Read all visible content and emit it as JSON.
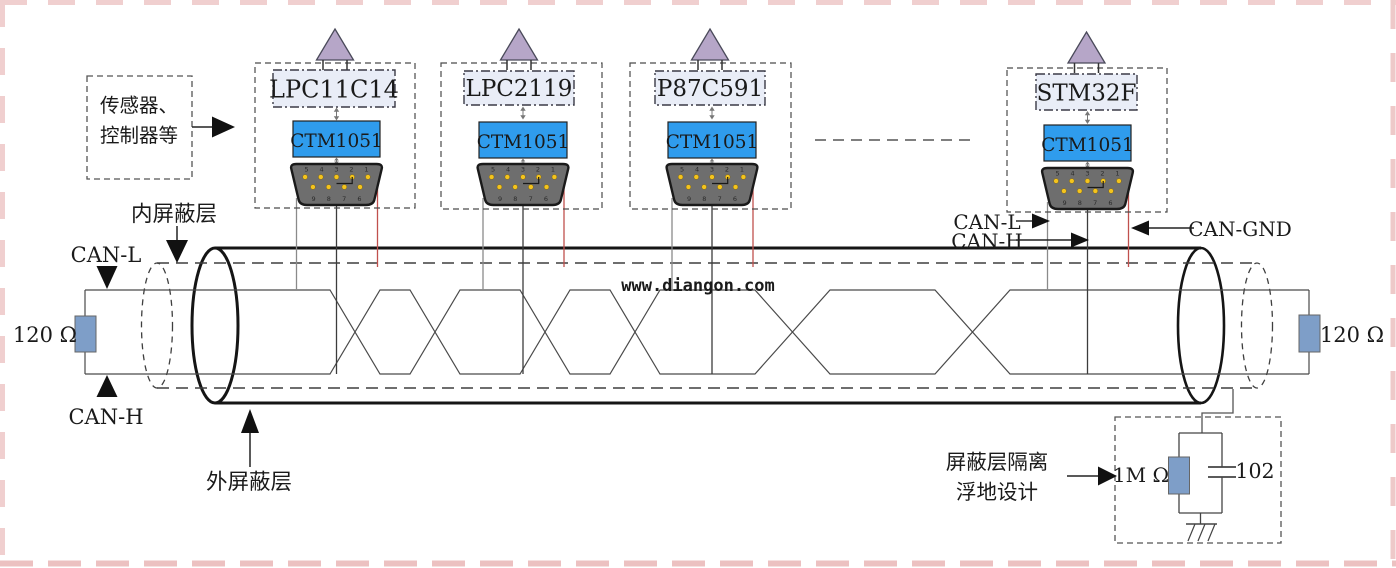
{
  "nodes": [
    {
      "mcu": "LPC11C14",
      "transceiver": "CTM1051"
    },
    {
      "mcu": "LPC2119",
      "transceiver": "CTM1051"
    },
    {
      "mcu": "P87C591",
      "transceiver": "CTM1051"
    },
    {
      "mcu": "STM32F",
      "transceiver": "CTM1051"
    }
  ],
  "db9": {
    "top_row": "5 4 3 2 1",
    "bottom_row": "9 8 7 6"
  },
  "labels": {
    "sensor_line1": "传感器、",
    "sensor_line2": "控制器等",
    "inner_shield": "内屏蔽层",
    "outer_shield": "外屏蔽层",
    "can_l_left": "CAN-L",
    "can_h_left": "CAN-H",
    "can_l_node": "CAN-L",
    "can_h_node": "CAN-H",
    "can_gnd": "CAN-GND",
    "terminator_left": "120 Ω",
    "terminator_right": "120 Ω"
  },
  "ground_circuit": {
    "note_line1": "屏蔽层隔离",
    "note_line2": "浮地设计",
    "resistor_value": "1M Ω",
    "capacitor_value": "102"
  },
  "watermark": "www.diangon.com",
  "colors": {
    "transceiver_blue": "#2f9ced",
    "mcu_box_fill": "#e9edf7",
    "antenna_purple": "#b6a6c8",
    "resistor_blue": "#7e9ec8",
    "connector_gray": "#6e6e6e",
    "pin_yellow": "#f4c41d",
    "gnd_wire_red": "#c0504d",
    "watermark_green": "#149a14",
    "page_border_pink": "#efcdcd"
  }
}
